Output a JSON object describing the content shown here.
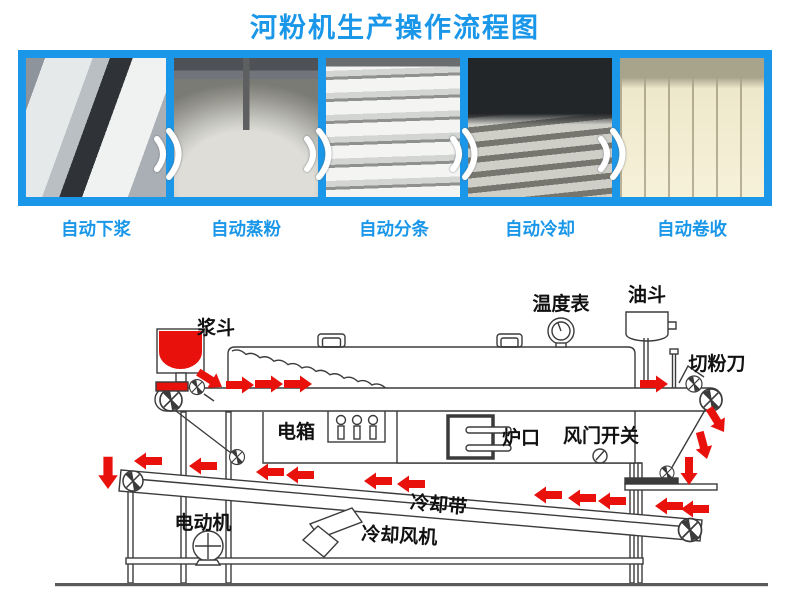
{
  "header": {
    "title": "河粉机生产操作流程图"
  },
  "process_steps": [
    {
      "label": "自动下浆"
    },
    {
      "label": "自动蒸粉"
    },
    {
      "label": "自动分条"
    },
    {
      "label": "自动冷却"
    },
    {
      "label": "自动卷收"
    }
  ],
  "diagram": {
    "labels": {
      "slurry_hopper": "浆斗",
      "temperature_gauge": "温度表",
      "oil_hopper": "油斗",
      "noodle_cutter": "切粉刀",
      "electric_box": "电箱",
      "furnace_mouth": "炉口",
      "damper_switch": "风门开关",
      "cooling_belt": "冷却带",
      "cooling_fan": "冷却风机",
      "electric_motor": "电动机"
    }
  },
  "colors": {
    "accent_blue": "#1b97e9",
    "arrow_red": "#e8110c",
    "hopper_red": "#e8110c",
    "line_dark": "#3b3b3b"
  }
}
